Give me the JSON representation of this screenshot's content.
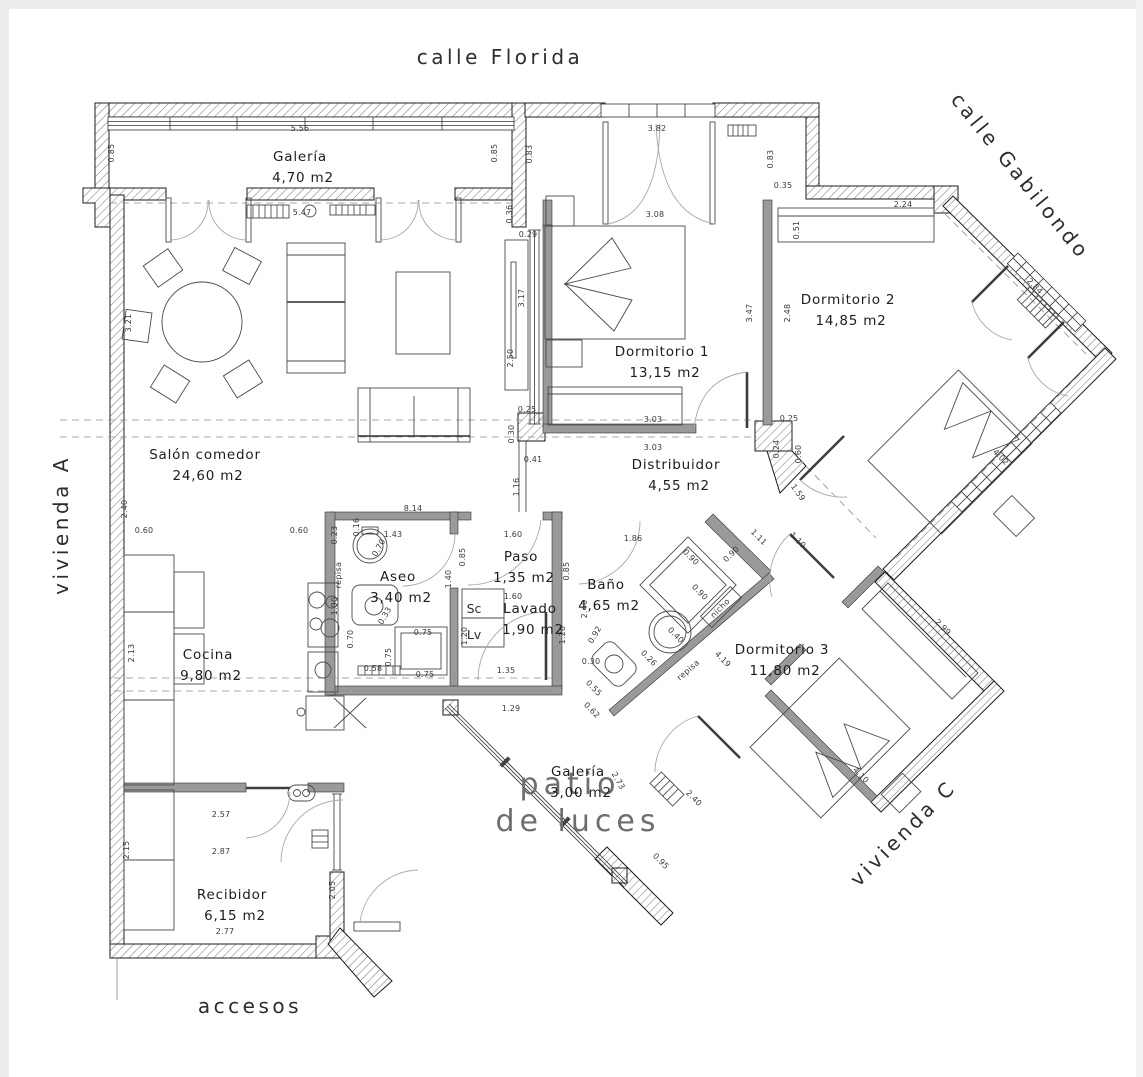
{
  "plan": {
    "colors": {
      "background": "#ffffff",
      "wall_hatch": "#808080",
      "line": "#2c2c2c",
      "interior_wall": "#9a9a9a"
    },
    "streets": [
      {
        "label": "calle Florida",
        "x": 500,
        "y": 64,
        "rotate": 0,
        "cls": "street",
        "anchor": "middle"
      },
      {
        "label": "calle Gabilondo",
        "x": 950,
        "y": 100,
        "rotate": 51,
        "cls": "street",
        "anchor": "start"
      },
      {
        "label": "vivienda A",
        "x": 68,
        "y": 525,
        "rotate": -90,
        "cls": "street",
        "anchor": "middle"
      },
      {
        "label": "vivienda C",
        "x": 908,
        "y": 838,
        "rotate": -45,
        "cls": "street",
        "anchor": "middle"
      },
      {
        "label": "accesos",
        "x": 250,
        "y": 1013,
        "rotate": 0,
        "cls": "street",
        "anchor": "middle"
      },
      {
        "label": "patio",
        "x": 570,
        "y": 794,
        "rotate": 0,
        "cls": "patio-text",
        "anchor": "middle"
      },
      {
        "label": "de luces",
        "x": 578,
        "y": 831,
        "rotate": 0,
        "cls": "patio-text",
        "anchor": "middle"
      }
    ],
    "rooms": [
      {
        "id": "galeria-norte",
        "name": "Galería",
        "area": "4,70 m2",
        "x": 300,
        "y": 161
      },
      {
        "id": "dormitorio-1",
        "name": "Dormitorio 1",
        "area": "13,15 m2",
        "x": 662,
        "y": 356
      },
      {
        "id": "dormitorio-2",
        "name": "Dormitorio 2",
        "area": "14,85 m2",
        "x": 848,
        "y": 304
      },
      {
        "id": "salon-comedor",
        "name": "Salón comedor",
        "area": "24,60 m2",
        "x": 205,
        "y": 459
      },
      {
        "id": "distribuidor",
        "name": "Distribuidor",
        "area": "4,55 m2",
        "x": 676,
        "y": 469
      },
      {
        "id": "cocina",
        "name": "Cocina",
        "area": "9,80 m2",
        "x": 208,
        "y": 659
      },
      {
        "id": "aseo",
        "name": "Aseo",
        "area": "3,40 m2",
        "x": 398,
        "y": 581
      },
      {
        "id": "paso",
        "name": "Paso",
        "area": "1,35 m2",
        "x": 521,
        "y": 561
      },
      {
        "id": "lavado",
        "name": "Lavado",
        "area": "1,90 m2",
        "x": 530,
        "y": 613
      },
      {
        "id": "bano",
        "name": "Baño",
        "area": "4,65 m2",
        "x": 606,
        "y": 589
      },
      {
        "id": "dormitorio-3",
        "name": "Dormitorio 3",
        "area": "11,80 m2",
        "x": 782,
        "y": 654
      },
      {
        "id": "galeria-patio",
        "name": "Galería",
        "area": "3,00 m2",
        "x": 578,
        "y": 776
      },
      {
        "id": "recibidor",
        "name": "Recibidor",
        "area": "6,15 m2",
        "x": 232,
        "y": 899
      }
    ],
    "closet_labels": [
      {
        "text": "Sc",
        "x": 474,
        "y": 613
      },
      {
        "text": "Lv",
        "x": 474,
        "y": 639
      }
    ],
    "annotations": [
      {
        "text": "repisa",
        "x": 341,
        "y": 575,
        "rotate": -90
      },
      {
        "text": "repisa",
        "x": 690,
        "y": 672,
        "rotate": -41
      },
      {
        "text": "nicho",
        "x": 722,
        "y": 610,
        "rotate": -45
      }
    ],
    "dimensions": [
      {
        "v": "5.56",
        "x": 300,
        "y": 131,
        "r": 0
      },
      {
        "v": "0.85",
        "x": 114,
        "y": 153,
        "r": -90
      },
      {
        "v": "0.85",
        "x": 497,
        "y": 153,
        "r": -90
      },
      {
        "v": "5.47",
        "x": 302,
        "y": 215,
        "r": 0
      },
      {
        "v": "3.82",
        "x": 657,
        "y": 131,
        "r": 0
      },
      {
        "v": "0.83",
        "x": 532,
        "y": 154,
        "r": -90
      },
      {
        "v": "0.83",
        "x": 773,
        "y": 159,
        "r": -90
      },
      {
        "v": "0.35",
        "x": 783,
        "y": 188,
        "r": 0
      },
      {
        "v": "3.08",
        "x": 655,
        "y": 217,
        "r": 0
      },
      {
        "v": "0.36",
        "x": 512,
        "y": 214,
        "r": -90
      },
      {
        "v": "0.29",
        "x": 528,
        "y": 237,
        "r": 0
      },
      {
        "v": "2.24",
        "x": 903,
        "y": 207,
        "r": 0
      },
      {
        "v": "0.51",
        "x": 799,
        "y": 230,
        "r": -90
      },
      {
        "v": "2.84",
        "x": 1033,
        "y": 288,
        "r": 45
      },
      {
        "v": "3.17",
        "x": 524,
        "y": 298,
        "r": -90
      },
      {
        "v": "2.50",
        "x": 513,
        "y": 358,
        "r": -90
      },
      {
        "v": "3.47",
        "x": 752,
        "y": 313,
        "r": -90
      },
      {
        "v": "2.48",
        "x": 790,
        "y": 313,
        "r": -90
      },
      {
        "v": "3.21",
        "x": 131,
        "y": 323,
        "r": -90
      },
      {
        "v": "2.40",
        "x": 127,
        "y": 509,
        "r": -90
      },
      {
        "v": "0.60",
        "x": 144,
        "y": 533,
        "r": 0
      },
      {
        "v": "0.25",
        "x": 527,
        "y": 412,
        "r": 0
      },
      {
        "v": "0.30",
        "x": 514,
        "y": 434,
        "r": -90
      },
      {
        "v": "0.41",
        "x": 533,
        "y": 462,
        "r": 0
      },
      {
        "v": "1.16",
        "x": 519,
        "y": 487,
        "r": -90
      },
      {
        "v": "3.03",
        "x": 653,
        "y": 422,
        "r": 0
      },
      {
        "v": "3.03",
        "x": 653,
        "y": 450,
        "r": 0
      },
      {
        "v": "0.25",
        "x": 789,
        "y": 421,
        "r": 0
      },
      {
        "v": "0.24",
        "x": 779,
        "y": 449,
        "r": -90
      },
      {
        "v": "0.60",
        "x": 801,
        "y": 454,
        "r": -90
      },
      {
        "v": "1.59",
        "x": 796,
        "y": 494,
        "r": 55
      },
      {
        "v": "1.11",
        "x": 757,
        "y": 539,
        "r": 45
      },
      {
        "v": "1.10",
        "x": 796,
        "y": 542,
        "r": 45
      },
      {
        "v": "4.02",
        "x": 999,
        "y": 459,
        "r": 45
      },
      {
        "v": "2.99",
        "x": 941,
        "y": 629,
        "r": 45
      },
      {
        "v": "4.10",
        "x": 859,
        "y": 777,
        "r": 45
      },
      {
        "v": "4.19",
        "x": 721,
        "y": 661,
        "r": 45
      },
      {
        "v": "0.95",
        "x": 659,
        "y": 863,
        "r": 45
      },
      {
        "v": "8.14",
        "x": 413,
        "y": 511,
        "r": 0
      },
      {
        "v": "0.60",
        "x": 299,
        "y": 533,
        "r": 0
      },
      {
        "v": "1.43",
        "x": 393,
        "y": 537,
        "r": 0
      },
      {
        "v": "0.23",
        "x": 337,
        "y": 535,
        "r": -90
      },
      {
        "v": "0.16",
        "x": 359,
        "y": 527,
        "r": -90
      },
      {
        "v": "0.70",
        "x": 381,
        "y": 549,
        "r": -60
      },
      {
        "v": "1.90",
        "x": 337,
        "y": 606,
        "r": -90
      },
      {
        "v": "0.85",
        "x": 465,
        "y": 557,
        "r": -90
      },
      {
        "v": "1.40",
        "x": 451,
        "y": 579,
        "r": -90
      },
      {
        "v": "1.60",
        "x": 513,
        "y": 537,
        "r": 0
      },
      {
        "v": "1.60",
        "x": 513,
        "y": 599,
        "r": 0
      },
      {
        "v": "0.70",
        "x": 353,
        "y": 639,
        "r": -90
      },
      {
        "v": "0.75",
        "x": 423,
        "y": 635,
        "r": 0
      },
      {
        "v": "0.75",
        "x": 391,
        "y": 657,
        "r": -90
      },
      {
        "v": "0.58",
        "x": 373,
        "y": 671,
        "r": 0
      },
      {
        "v": "0.75",
        "x": 425,
        "y": 677,
        "r": 0
      },
      {
        "v": "0.33",
        "x": 387,
        "y": 617,
        "r": -60
      },
      {
        "v": "1.20",
        "x": 467,
        "y": 636,
        "r": -90
      },
      {
        "v": "1.20",
        "x": 565,
        "y": 635,
        "r": -90
      },
      {
        "v": "1.35",
        "x": 506,
        "y": 673,
        "r": 0
      },
      {
        "v": "1.29",
        "x": 511,
        "y": 711,
        "r": 0
      },
      {
        "v": "1.86",
        "x": 633,
        "y": 541,
        "r": 0
      },
      {
        "v": "0.85",
        "x": 569,
        "y": 571,
        "r": -90
      },
      {
        "v": "2.40",
        "x": 587,
        "y": 609,
        "r": -90
      },
      {
        "v": "0.92",
        "x": 597,
        "y": 636,
        "r": -60
      },
      {
        "v": "0.90",
        "x": 689,
        "y": 559,
        "r": 45
      },
      {
        "v": "0.90",
        "x": 733,
        "y": 556,
        "r": -45
      },
      {
        "v": "0.90",
        "x": 698,
        "y": 594,
        "r": 45
      },
      {
        "v": "0.40",
        "x": 674,
        "y": 637,
        "r": 45
      },
      {
        "v": "0.26",
        "x": 647,
        "y": 660,
        "r": 45
      },
      {
        "v": "0.30",
        "x": 591,
        "y": 664,
        "r": 0
      },
      {
        "v": "0.55",
        "x": 592,
        "y": 690,
        "r": 45
      },
      {
        "v": "0.62",
        "x": 590,
        "y": 712,
        "r": 45
      },
      {
        "v": "2.73",
        "x": 616,
        "y": 782,
        "r": 60
      },
      {
        "v": "2.40",
        "x": 692,
        "y": 800,
        "r": 45
      },
      {
        "v": "2.13",
        "x": 134,
        "y": 653,
        "r": -90
      },
      {
        "v": "2.57",
        "x": 221,
        "y": 817,
        "r": 0
      },
      {
        "v": "2.87",
        "x": 221,
        "y": 854,
        "r": 0
      },
      {
        "v": "2.15",
        "x": 129,
        "y": 850,
        "r": -90
      },
      {
        "v": "2.77",
        "x": 225,
        "y": 934,
        "r": 0
      },
      {
        "v": "2.05",
        "x": 335,
        "y": 890,
        "r": -90
      }
    ]
  }
}
